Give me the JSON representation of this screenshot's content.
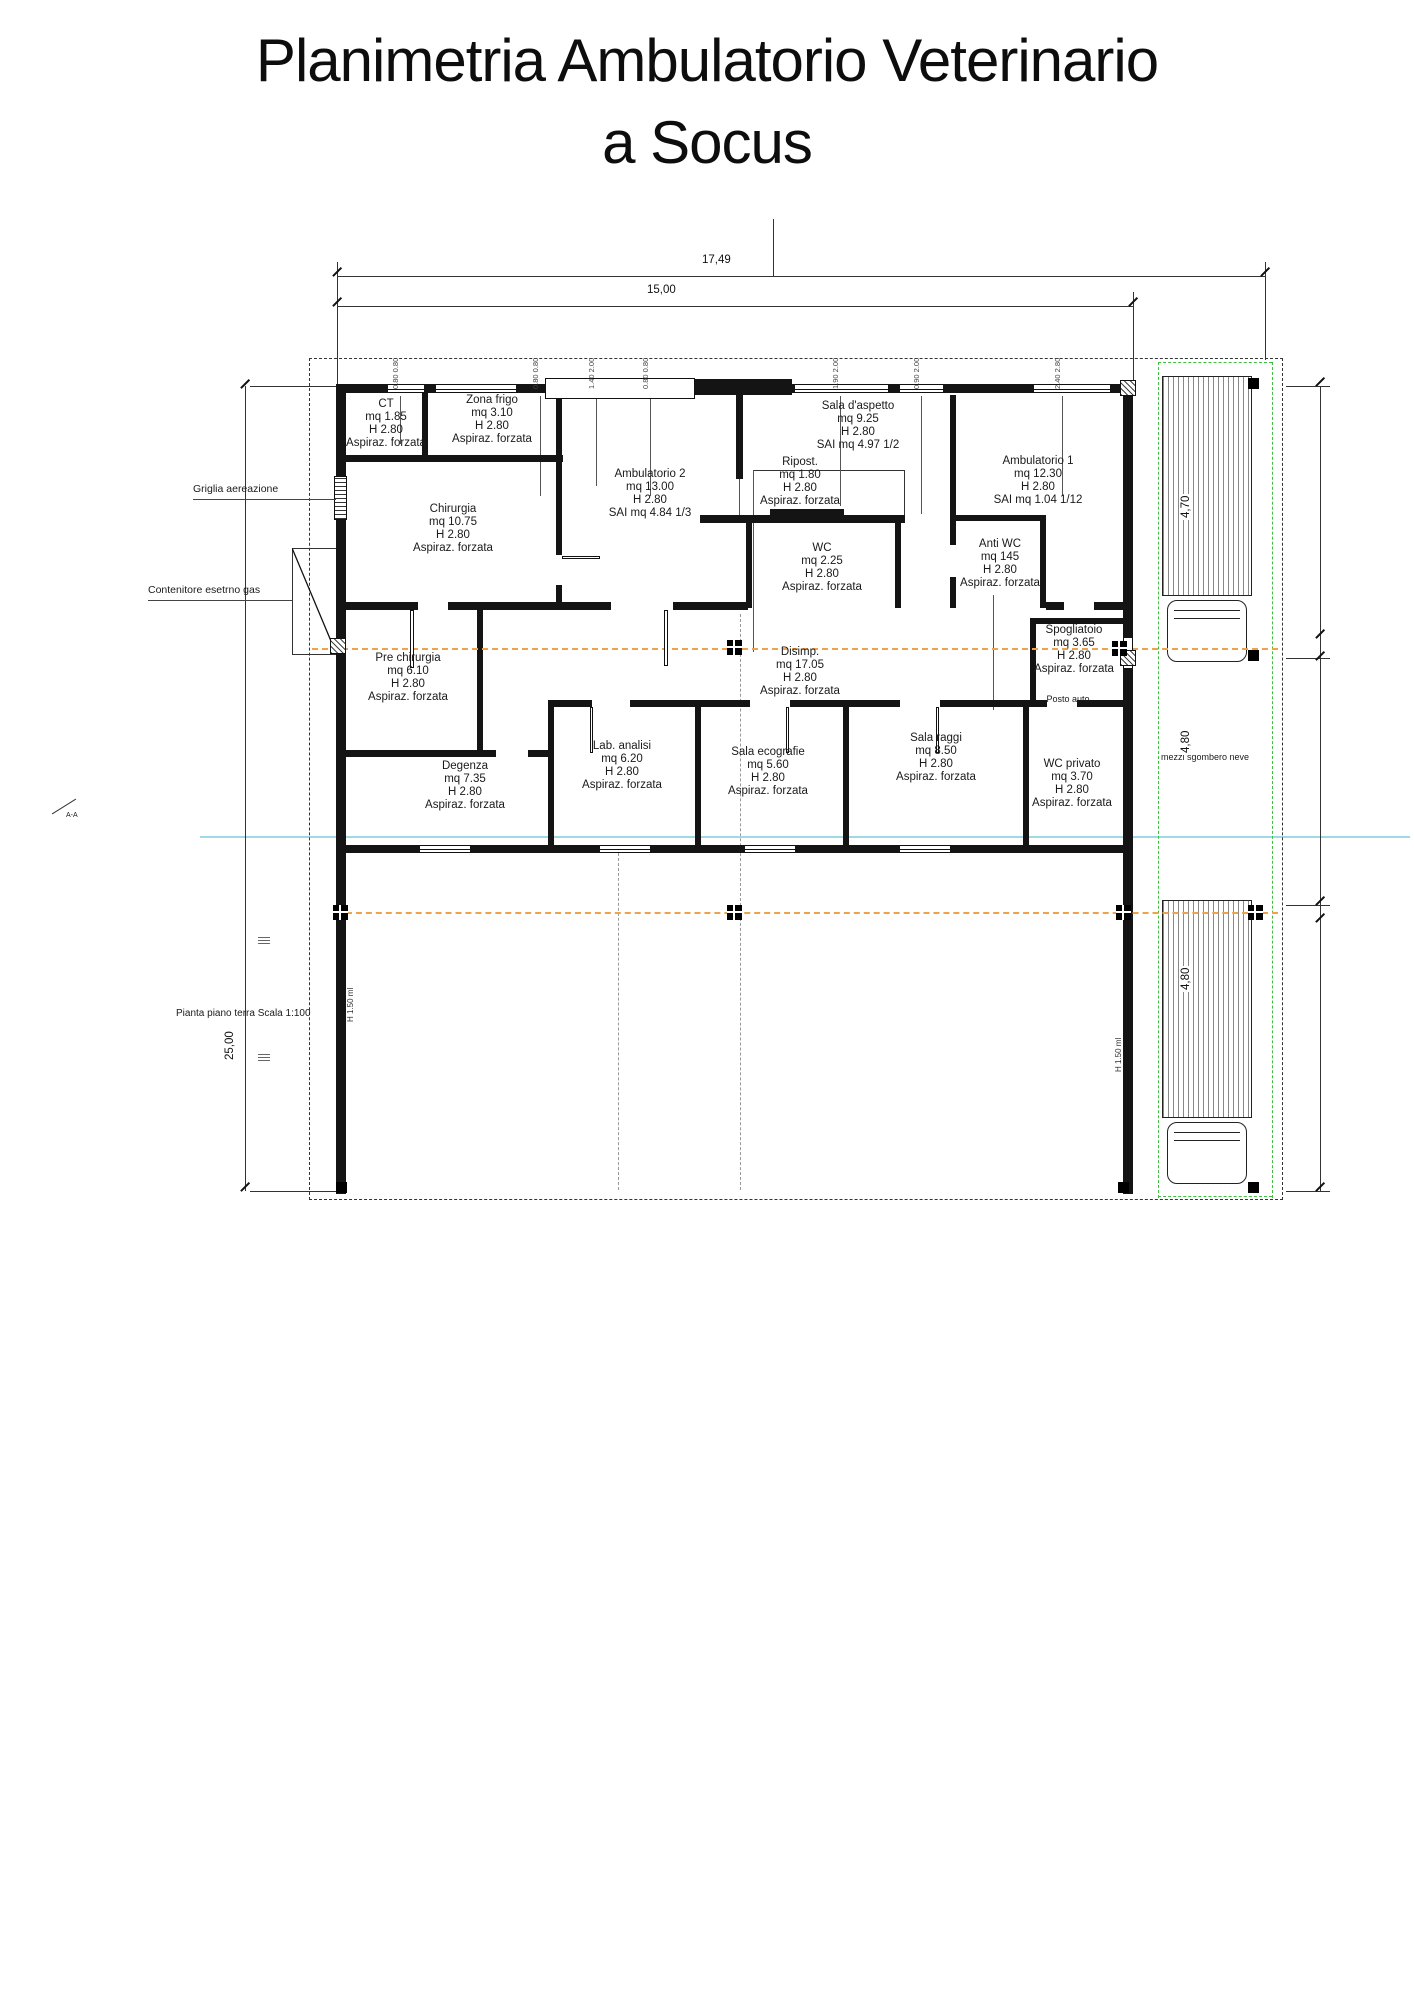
{
  "title": {
    "line1": "Planimetria Ambulatorio Veterinario",
    "line2": "a Socus"
  },
  "dimensions": {
    "top_outer": "17,49",
    "top_inner": "15,00",
    "left": "25,00",
    "right": [
      "4,70",
      "4,80",
      "4,80"
    ]
  },
  "annotations": {
    "griglia": "Griglia aereazione",
    "contenitore": "Contenitore esetrno gas",
    "scala": "Pianta piano terra Scala 1:100",
    "posto_auto": "Posto auto",
    "mezzi": "mezzi sgombero neve",
    "section": "A-A",
    "parapet_left": "H 1.50 ml",
    "parapet_right": "H 1.50 ml"
  },
  "window_labels": [
    "0.80 0.80",
    "0.80 0.80",
    "1.40 2.00",
    "0.80 0.80",
    "1.90 2.00",
    "0.90 2.00",
    "2.40 2.80"
  ],
  "rooms": [
    {
      "name": "CT",
      "l1": "mq 1.85",
      "l2": "H 2.80",
      "l3": "Aspiraz. forzata"
    },
    {
      "name": "Zona frigo",
      "l1": "mq 3.10",
      "l2": "H 2.80",
      "l3": "Aspiraz. forzata"
    },
    {
      "name": "Chirurgia",
      "l1": "mq 10.75",
      "l2": "H 2.80",
      "l3": "Aspiraz. forzata"
    },
    {
      "name": "Ambulatorio 2",
      "l1": "mq 13.00",
      "l2": "H 2.80",
      "l3": "SAI mq 4.84 1/3"
    },
    {
      "name": "Sala d'aspetto",
      "l1": "mq 9.25",
      "l2": "H 2.80",
      "l3": "SAI mq 4.97 1/2"
    },
    {
      "name": "Ripost.",
      "l1": "mq 1.80",
      "l2": "H 2.80",
      "l3": "Aspiraz. forzata"
    },
    {
      "name": "WC",
      "l1": "mq 2.25",
      "l2": "H 2.80",
      "l3": "Aspiraz. forzata"
    },
    {
      "name": "Anti WC",
      "l1": "mq 145",
      "l2": "H 2.80",
      "l3": "Aspiraz. forzata"
    },
    {
      "name": "Ambulatorio 1",
      "l1": "mq 12.30",
      "l2": "H 2.80",
      "l3": "SAI mq 1.04 1/12"
    },
    {
      "name": "Pre chirurgia",
      "l1": "mq 6.10",
      "l2": "H 2.80",
      "l3": "Aspiraz. forzata"
    },
    {
      "name": "Disimp.",
      "l1": "mq 17.05",
      "l2": "H 2.80",
      "l3": "Aspiraz. forzata"
    },
    {
      "name": "Spogliatoio",
      "l1": "mq 3.65",
      "l2": "H 2.80",
      "l3": "Aspiraz. forzata"
    },
    {
      "name": "Degenza",
      "l1": "mq 7.35",
      "l2": "H 2.80",
      "l3": "Aspiraz. forzata"
    },
    {
      "name": "Lab. analisi",
      "l1": "mq 6.20",
      "l2": "H 2.80",
      "l3": "Aspiraz. forzata"
    },
    {
      "name": "Sala ecografie",
      "l1": "mq 5.60",
      "l2": "H 2.80",
      "l3": "Aspiraz. forzata"
    },
    {
      "name": "Sala raggi",
      "l1": "mq 8.50",
      "l2": "H 2.80",
      "l3": "Aspiraz. forzata"
    },
    {
      "name": "WC privato",
      "l1": "mq 3.70",
      "l2": "H 2.80",
      "l3": "Aspiraz. forzata"
    }
  ],
  "colors": {
    "wall": "#141414",
    "orange_dash": "#f0a24b",
    "cyan_line": "#9fd9e6",
    "green_dash": "#3fbf3f"
  }
}
